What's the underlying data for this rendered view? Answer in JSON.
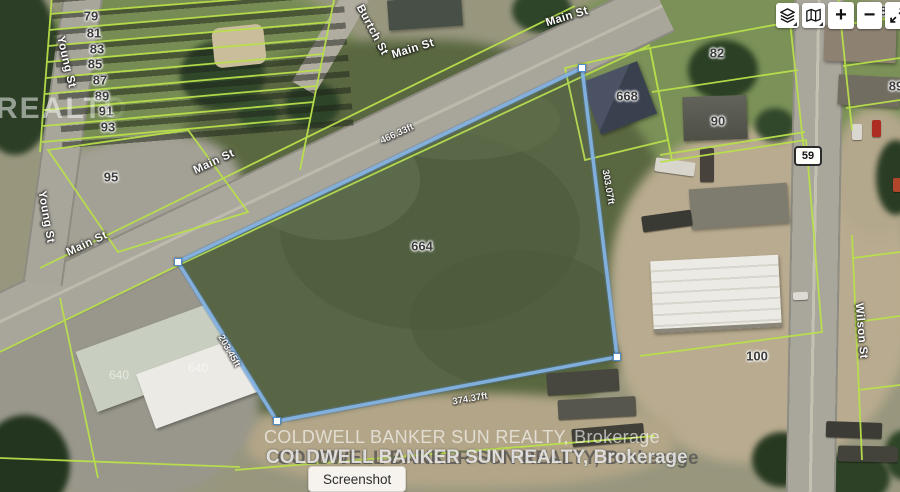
{
  "street_labels": [
    {
      "text": "Main St",
      "x": 567,
      "y": 17,
      "rot": -17
    },
    {
      "text": "Main St",
      "x": 413,
      "y": 49,
      "rot": -17
    },
    {
      "text": "Main St",
      "x": 214,
      "y": 162,
      "rot": -25
    },
    {
      "text": "Main St",
      "x": 87,
      "y": 244,
      "rot": -25
    },
    {
      "text": "Young St",
      "x": 66,
      "y": 62,
      "rot": 77
    },
    {
      "text": "Young St",
      "x": 46,
      "y": 217,
      "rot": 80
    },
    {
      "text": "Burtch St",
      "x": 372,
      "y": 30,
      "rot": 62
    },
    {
      "text": "Wilson St",
      "x": 861,
      "y": 331,
      "rot": 85
    }
  ],
  "parcel_numbers": [
    {
      "text": "79",
      "x": 91,
      "y": 16
    },
    {
      "text": "81",
      "x": 94,
      "y": 33
    },
    {
      "text": "83",
      "x": 97,
      "y": 49
    },
    {
      "text": "85",
      "x": 95,
      "y": 64
    },
    {
      "text": "87",
      "x": 100,
      "y": 80
    },
    {
      "text": "89",
      "x": 102,
      "y": 96
    },
    {
      "text": "91",
      "x": 106,
      "y": 111
    },
    {
      "text": "93",
      "x": 108,
      "y": 127
    },
    {
      "text": "95",
      "x": 111,
      "y": 177
    },
    {
      "text": "82",
      "x": 717,
      "y": 53
    },
    {
      "text": "90",
      "x": 718,
      "y": 121
    },
    {
      "text": "83",
      "x": 887,
      "y": 11
    },
    {
      "text": "89",
      "x": 896,
      "y": 86
    },
    {
      "text": "668",
      "x": 627,
      "y": 96
    },
    {
      "text": "664",
      "x": 422,
      "y": 246
    },
    {
      "text": "100",
      "x": 757,
      "y": 356
    },
    {
      "text": "640",
      "x": 119,
      "y": 375,
      "faint": true
    },
    {
      "text": "640",
      "x": 198,
      "y": 368,
      "faint": true
    }
  ],
  "measurements": [
    {
      "text": "466.33ft",
      "x": 397,
      "y": 134,
      "rot": -25
    },
    {
      "text": "303.07ft",
      "x": 608,
      "y": 187,
      "rot": 80
    },
    {
      "text": "374.37ft",
      "x": 470,
      "y": 399,
      "rot": -10
    },
    {
      "text": "203.45ft",
      "x": 229,
      "y": 351,
      "rot": 60
    }
  ],
  "highway_badge": {
    "text": "59"
  },
  "subject_parcel": {
    "points": "582,68 617,357 277,421 178,262",
    "handles": [
      {
        "x": 582,
        "y": 68
      },
      {
        "x": 617,
        "y": 357
      },
      {
        "x": 277,
        "y": 421
      },
      {
        "x": 178,
        "y": 262
      }
    ],
    "line_color": "#84b2e2"
  },
  "watermarks": {
    "left_fragment": "REALTO",
    "line1": "COLDWELL BANKER SUN REALTY, Brokerage",
    "line2a": "COLDWELL BANKER SUN REALTY, Brokerage",
    "line2b": "COLDWELL BANKER SUN REALTY, Brokerage"
  },
  "buttons": {
    "screenshot": "Screenshot",
    "zoom_in": "+",
    "zoom_out": "−"
  },
  "control_icons": [
    "layers-icon",
    "basemap-icon",
    "zoom-in",
    "zoom-out",
    "fullscreen-icon"
  ]
}
